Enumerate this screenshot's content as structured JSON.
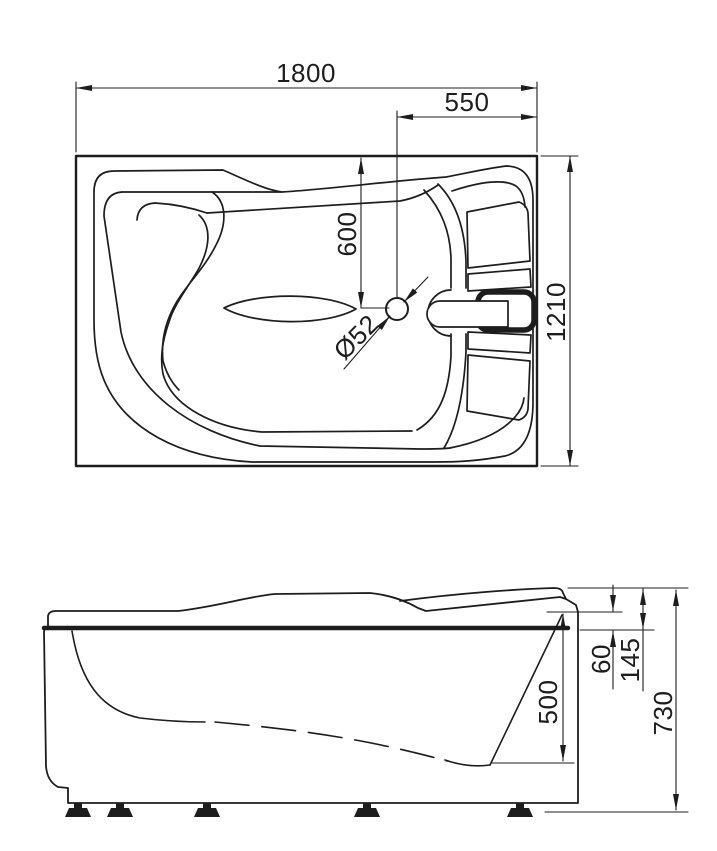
{
  "colors": {
    "line": "#1d1d1d",
    "background": "#ffffff"
  },
  "top_view": {
    "dims": {
      "overall_length": "1800",
      "drain_offset_from_right": "550",
      "drain_offset_from_back": "600",
      "drain_diameter": "Ø52",
      "overall_width": "1210"
    }
  },
  "side_view": {
    "dims": {
      "inner_depth": "500",
      "deck_step": "60",
      "headrest_rise": "145",
      "overall_height": "730"
    }
  }
}
